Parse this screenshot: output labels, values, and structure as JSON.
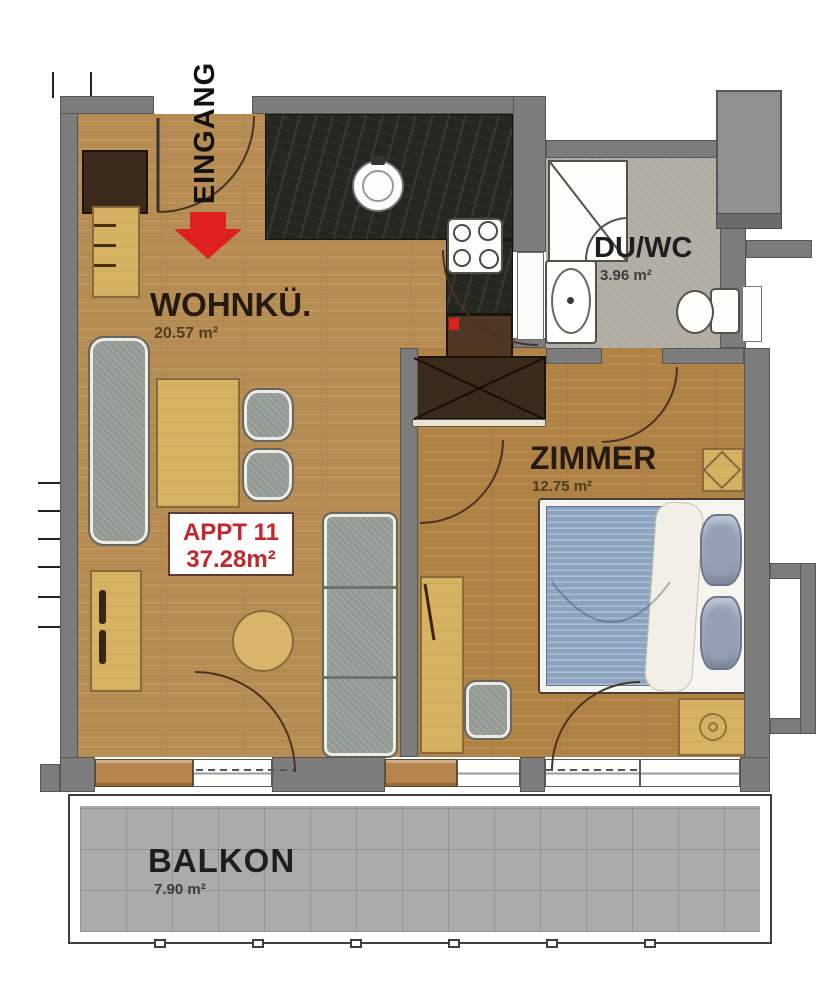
{
  "title": "Apartment floor plan",
  "plan": {
    "entrance_label": "EINGANG",
    "apartment": {
      "name": "APPT 11",
      "area": "37.28m²"
    },
    "rooms": [
      {
        "id": "wohnkueche",
        "name": "WOHNKÜ.",
        "area": "20.57 m²"
      },
      {
        "id": "du-wc",
        "name": "DU/WC",
        "area": "3.96 m²"
      },
      {
        "id": "zimmer",
        "name": "ZIMMER",
        "area": "12.75 m²"
      },
      {
        "id": "balkon",
        "name": "BALKON",
        "area": "7.90 m²"
      }
    ]
  },
  "colors": {
    "wall": "#7c7c7c",
    "wall-dark": "#6b6b6b",
    "wood": "#b78c52",
    "wood-bedroom": "#b08243",
    "bath-floor": "#b2ada4",
    "balcony-tile": "#ababab",
    "counter-dark": "#24261f",
    "accent-red": "#e02020",
    "appt-red": "#c4272b",
    "label-dark": "#241a10",
    "furniture-light": "#d8b263",
    "furniture-gray": "#9aa09a",
    "bed-blue": "#8ca3bf",
    "wardrobe-dark": "#3a2a1b"
  }
}
